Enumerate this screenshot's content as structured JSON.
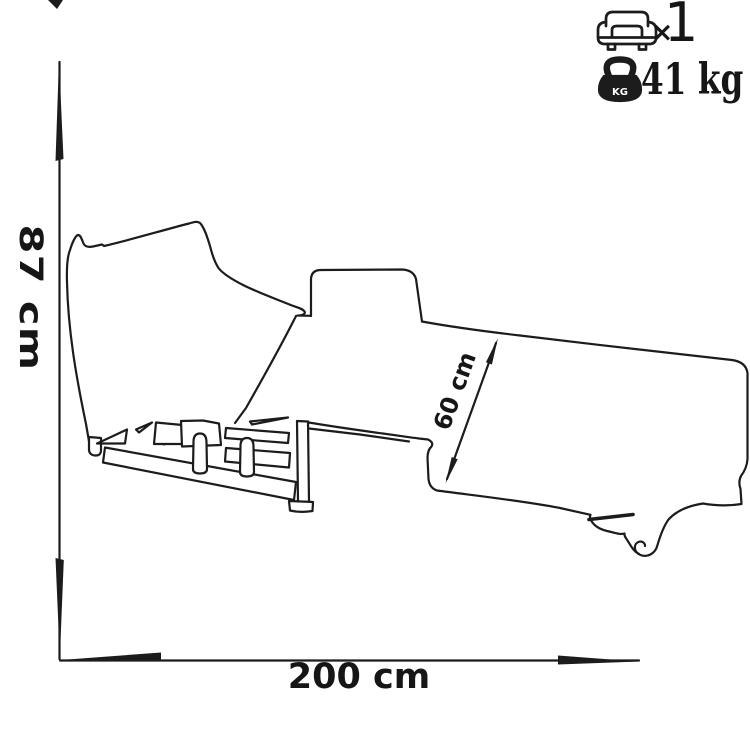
{
  "labels": {
    "height": "87 cm",
    "width": "200 cm",
    "depth": "60 cm"
  },
  "specs": {
    "seats_multiplier": "×",
    "seats_count": "1",
    "weight": "41 kg",
    "weight_icon_label": "KG"
  },
  "icons": {
    "seats": "armchair-icon",
    "weight": "kettlebell-icon"
  },
  "colors": {
    "ink": "#1c1c1c",
    "background": "#ffffff"
  }
}
